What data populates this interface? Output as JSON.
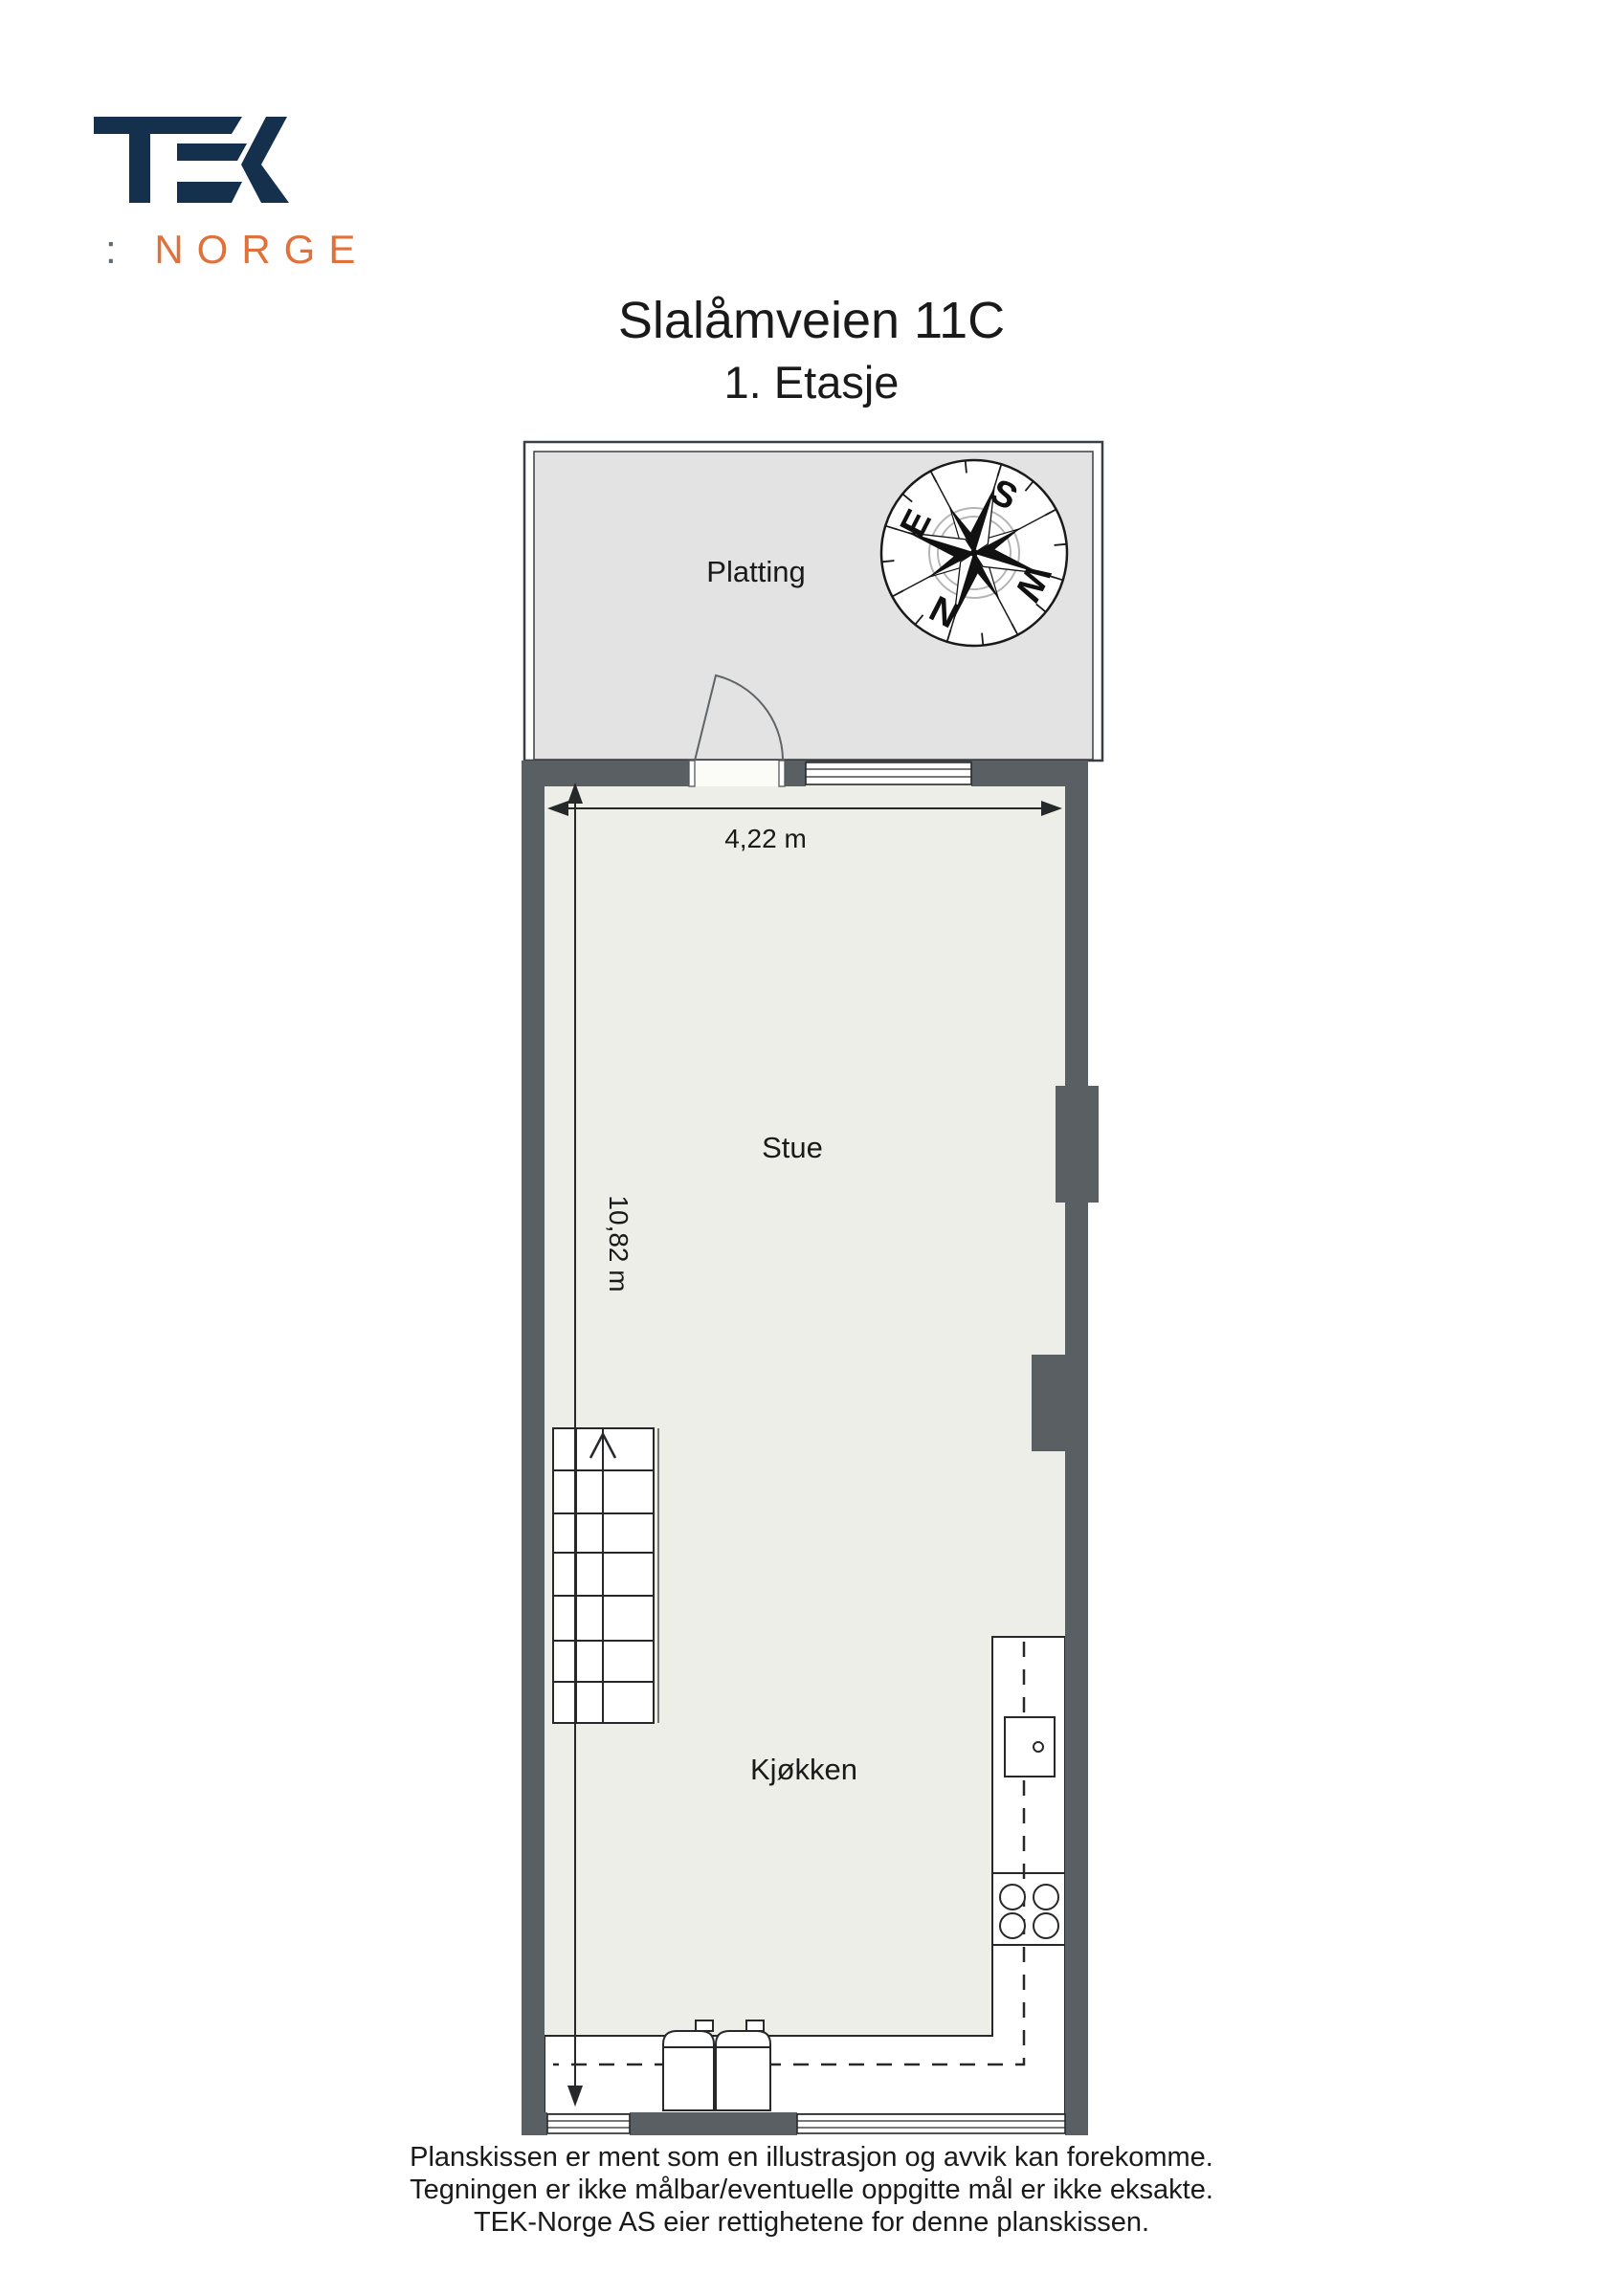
{
  "logo": {
    "brand": "TEK",
    "norge_colon": ":",
    "norge_text": "NORGE",
    "navy": "#14304d",
    "orange": "#e0713b",
    "colon_gray": "#5b6b78"
  },
  "header": {
    "title": "Slalåmveien 11C",
    "subtitle": "1. Etasje"
  },
  "plan": {
    "rooms": [
      {
        "name": "Platting"
      },
      {
        "name": "Stue"
      },
      {
        "name": "Kjøkken"
      }
    ],
    "dimensions": {
      "width": "4,22 m",
      "height": "10,82 m"
    },
    "compass": {
      "n": "N",
      "e": "E",
      "s": "S",
      "w": "W"
    },
    "colors": {
      "wall": "#5a5f64",
      "floor": "#edeee8",
      "platting": "#e2e3e2"
    }
  },
  "footer": {
    "lines": [
      "Planskissen er ment som en illustrasjon og avvik kan forekomme.",
      "Tegningen er ikke målbar/eventuelle oppgitte mål er ikke eksakte.",
      "TEK-Norge AS eier rettighetene for denne planskissen."
    ]
  }
}
